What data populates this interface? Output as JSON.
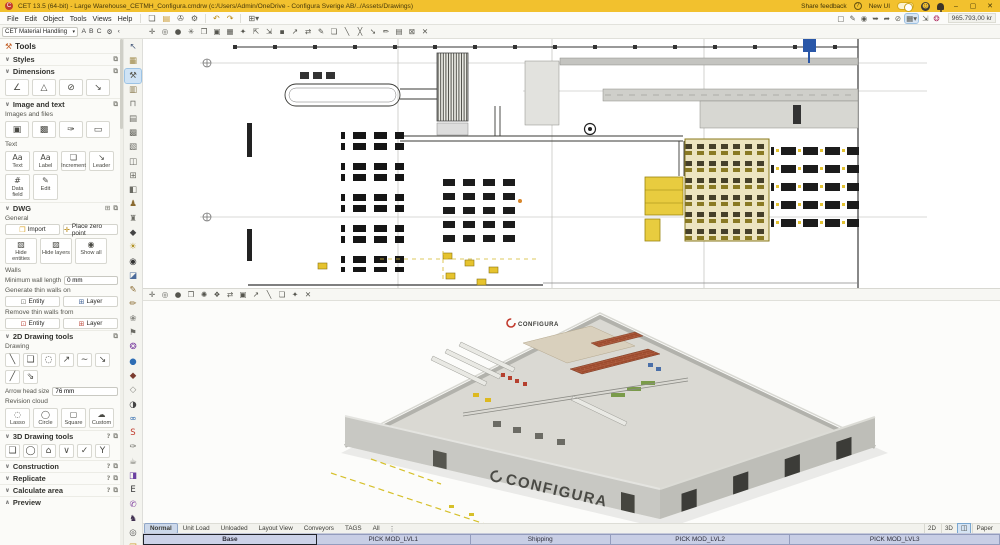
{
  "title_bar": {
    "app_title": "CET 13.5 (64-bit) - Large Warehouse_CETMH_Configura.cmdrw (c:/Users/Admin/OneDrive - Configura Sverige AB/../Assets/Drawings)",
    "share_feedback": "Share feedback",
    "new_ui": "New UI",
    "window_buttons": {
      "minimize": "–",
      "maximize": "▢",
      "close": "✕"
    }
  },
  "menubar": {
    "menus": [
      "File",
      "Edit",
      "Object",
      "Tools",
      "Views",
      "Help"
    ],
    "file_icons": [
      {
        "name": "new-drawing-icon",
        "glyph": "❏"
      },
      {
        "name": "open-folder-icon",
        "glyph": "▤",
        "color": "#c9972a"
      },
      {
        "name": "save-icon",
        "glyph": "✇"
      },
      {
        "name": "settings-gear-icon",
        "glyph": "⚙"
      }
    ],
    "history_icons": [
      {
        "name": "undo-icon",
        "glyph": "↶",
        "color": "#b8860b"
      },
      {
        "name": "redo-icon",
        "glyph": "↷",
        "color": "#b8860b"
      }
    ],
    "insert_icon": {
      "name": "insert-table-icon",
      "glyph": "⊞▾"
    },
    "right_icons": [
      {
        "name": "frame-icon",
        "glyph": "▢"
      },
      {
        "name": "draw-icon",
        "glyph": "✎"
      },
      {
        "name": "snap-point-icon",
        "glyph": "◉"
      },
      {
        "name": "snap-line-icon",
        "glyph": "➥"
      },
      {
        "name": "snap-angle-icon",
        "glyph": "➦"
      },
      {
        "name": "no-snap-icon",
        "glyph": "⊘"
      },
      {
        "name": "grid-settings-icon",
        "glyph": "▦▾",
        "selected": true
      },
      {
        "name": "measure-icon",
        "glyph": "⇲"
      },
      {
        "name": "record-icon",
        "glyph": "❂",
        "color": "#b03565"
      }
    ],
    "coordinates": "965.793,00 kr"
  },
  "ribbon": {
    "extension": "CET Material Handling",
    "letters": [
      "A",
      "B",
      "C"
    ],
    "gear": "⚙",
    "collapse": "‹"
  },
  "icon_strip": [
    {
      "name": "select-tool-icon",
      "glyph": "↖",
      "color": "#4a5d7e"
    },
    {
      "name": "pallets-icon",
      "glyph": "▦",
      "color": "#a08a4a"
    },
    {
      "name": "material-handling-tools-icon",
      "glyph": "⚒",
      "color": "#55534a",
      "selected": true
    },
    {
      "name": "unit-loads-icon",
      "glyph": "▥",
      "color": "#8a7a50"
    },
    {
      "name": "dock-equipment-icon",
      "glyph": "⊓",
      "color": "#6b6b64"
    },
    {
      "name": "pallet-rack-icon",
      "glyph": "▤",
      "color": "#6b6b64"
    },
    {
      "name": "shelving-icon",
      "glyph": "▩",
      "color": "#6b6b64"
    },
    {
      "name": "mezzanine-icon",
      "glyph": "▧",
      "color": "#6b6b64"
    },
    {
      "name": "conveyor-icon",
      "glyph": "◫",
      "color": "#6b6b64"
    },
    {
      "name": "workstation-icon",
      "glyph": "⊞",
      "color": "#6b6b64"
    },
    {
      "name": "machinery-icon",
      "glyph": "◧",
      "color": "#6b6b64"
    },
    {
      "name": "operator-icon",
      "glyph": "♟",
      "color": "#8a6a30"
    },
    {
      "name": "crane-icon",
      "glyph": "♜",
      "color": "#6b6b64"
    },
    {
      "name": "forklift-icon",
      "glyph": "◆",
      "color": "#444444"
    },
    {
      "name": "lighting-icon",
      "glyph": "☀",
      "color": "#b09020"
    },
    {
      "name": "vehicle-icon",
      "glyph": "◉",
      "color": "#333333"
    },
    {
      "name": "monitor-icon",
      "glyph": "◪",
      "color": "#4a6a9a"
    },
    {
      "name": "pencil-icon",
      "glyph": "✎",
      "color": "#8a6a30"
    },
    {
      "name": "sketch-icon",
      "glyph": "✏",
      "color": "#8a6a30"
    },
    {
      "name": "render-icon",
      "glyph": "❀",
      "color": "#8a8a84"
    },
    {
      "name": "flag-icon",
      "glyph": "⚑",
      "color": "#6b6b64"
    },
    {
      "name": "pinwheel-icon",
      "glyph": "❂",
      "color": "#7b3fa0"
    },
    {
      "name": "globe-icon",
      "glyph": "●",
      "color": "#2e6db4"
    },
    {
      "name": "cad-icon",
      "glyph": "◆",
      "color": "#7a3b2e"
    },
    {
      "name": "export-icon",
      "glyph": "◇",
      "color": "#8a8a84"
    },
    {
      "name": "gauge-icon",
      "glyph": "◑",
      "color": "#444444"
    },
    {
      "name": "sync-icon",
      "glyph": "∞",
      "color": "#1f5fa8"
    },
    {
      "name": "sketchup-icon",
      "glyph": "S",
      "color": "#c0392b"
    },
    {
      "name": "annotation-icon",
      "glyph": "✑",
      "color": "#6b6b64"
    },
    {
      "name": "bucket-icon",
      "glyph": "☕",
      "color": "#6b6b64"
    },
    {
      "name": "media-panel-icon",
      "glyph": "◨",
      "color": "#6a3fa0"
    },
    {
      "name": "e-learning-icon",
      "glyph": "E",
      "color": "#333333"
    },
    {
      "name": "support-icon",
      "glyph": "✆",
      "color": "#8040a0"
    },
    {
      "name": "figure-icon",
      "glyph": "♞",
      "color": "#403050"
    },
    {
      "name": "search-icon",
      "glyph": "◎",
      "color": "#555555"
    },
    {
      "name": "folder-icon",
      "glyph": "❒",
      "color": "#d0a030"
    }
  ],
  "sidebar": {
    "title": "Tools",
    "sections": {
      "styles": "Styles",
      "dimensions": "Dimensions",
      "image_text": "Image and text",
      "dwg": "DWG",
      "drawing2d": "2D Drawing tools",
      "drawing3d": "3D Drawing tools",
      "construction": "Construction",
      "replicate": "Replicate",
      "calculate": "Calculate area",
      "preview": "Preview"
    },
    "dimension_tools": [
      {
        "name": "angular-dimension-icon",
        "glyph": "∠"
      },
      {
        "name": "area-dimension-icon",
        "glyph": "△"
      },
      {
        "name": "diameter-dimension-icon",
        "glyph": "⊘"
      },
      {
        "name": "linear-dimension-icon",
        "glyph": "↘"
      }
    ],
    "images_files_label": "Images and files",
    "image_tools": [
      {
        "name": "insert-image-icon",
        "glyph": "▣"
      },
      {
        "name": "image-frame-icon",
        "glyph": "▩"
      },
      {
        "name": "attach-file-icon",
        "glyph": "✑"
      },
      {
        "name": "viewport-image-icon",
        "glyph": "▭"
      }
    ],
    "text_label": "Text",
    "text_tools": [
      {
        "label": "Text",
        "glyph": "Aa",
        "name": "text-tool"
      },
      {
        "label": "Label",
        "glyph": "Aa",
        "name": "label-tool"
      },
      {
        "label": "Increment",
        "glyph": "❏",
        "name": "increment-tool"
      },
      {
        "label": "Leader",
        "glyph": "↘",
        "name": "leader-tool"
      },
      {
        "label": "Data field",
        "glyph": "#",
        "name": "data-field-tool"
      },
      {
        "label": "Edit",
        "glyph": "✎",
        "name": "edit-text-tool"
      }
    ],
    "dwg": {
      "general_label": "General",
      "import_label": "Import",
      "place_zero_label": "Place zero point",
      "view_buttons": [
        {
          "label": "Hide entities",
          "glyph": "▧",
          "name": "hide-entities-button"
        },
        {
          "label": "Hide layers",
          "glyph": "▨",
          "name": "hide-layers-button"
        },
        {
          "label": "Show all",
          "glyph": "◉",
          "name": "show-all-button"
        }
      ],
      "walls_label": "Walls",
      "min_wall_label": "Minimum wall length",
      "min_wall_value": "0 mm",
      "generate_label": "Generate thin walls on",
      "remove_label": "Remove thin walls from",
      "entity_label": "Entity",
      "layer_label": "Layer"
    },
    "drawing2d": {
      "drawing_label": "Drawing",
      "tools": [
        {
          "name": "line-tool-icon",
          "glyph": "╲"
        },
        {
          "name": "rectangle-tool-icon",
          "glyph": "❑"
        },
        {
          "name": "circle-tool-icon",
          "glyph": "◌"
        },
        {
          "name": "arrow-tool-icon",
          "glyph": "↗"
        },
        {
          "name": "curve-tool-icon",
          "glyph": "∼"
        },
        {
          "name": "double-arrow-tool-icon",
          "glyph": "↘"
        },
        {
          "name": "polyline-tool-icon",
          "glyph": "╱"
        },
        {
          "name": "leader-arrow-tool-icon",
          "glyph": "⇘"
        }
      ],
      "arrow_label": "Arrow head size",
      "arrow_value": "76 mm",
      "revision_label": "Revision cloud",
      "revision_tools": [
        {
          "label": "Lasso",
          "glyph": "◌",
          "name": "revision-lasso-tool"
        },
        {
          "label": "Circle",
          "glyph": "◯",
          "name": "revision-circle-tool"
        },
        {
          "label": "Square",
          "glyph": "▢",
          "name": "revision-square-tool"
        },
        {
          "label": "Custom",
          "glyph": "☁",
          "color": "#a06a9a",
          "name": "revision-custom-tool"
        }
      ]
    },
    "drawing3d_tools": [
      {
        "name": "box-3d-icon",
        "glyph": "❑"
      },
      {
        "name": "cylinder-3d-icon",
        "glyph": "◯"
      },
      {
        "name": "polygon-3d-icon",
        "glyph": "⌂"
      },
      {
        "name": "valley-3d-icon",
        "glyph": "∨"
      },
      {
        "name": "check-3d-icon",
        "glyph": "✓"
      },
      {
        "name": "wye-3d-icon",
        "glyph": "Y"
      }
    ]
  },
  "viewport2d": {
    "toolbar": [
      {
        "name": "pan-icon",
        "glyph": "✛"
      },
      {
        "name": "zoom-icon",
        "glyph": "◎"
      },
      {
        "name": "zoom-selection-icon",
        "glyph": "●"
      },
      {
        "name": "zoom-extents-icon",
        "glyph": "✳"
      },
      {
        "name": "previous-view-icon",
        "glyph": "❐"
      },
      {
        "name": "save-view-icon",
        "glyph": "▣"
      },
      {
        "name": "grid-icon",
        "glyph": "▦"
      },
      {
        "name": "snap-icon",
        "glyph": "✦"
      },
      {
        "name": "send-back-icon",
        "glyph": "⇱"
      },
      {
        "name": "bring-front-icon",
        "glyph": "⇲"
      },
      {
        "name": "fill-icon",
        "glyph": "▪"
      },
      {
        "name": "move-icon",
        "glyph": "↗"
      },
      {
        "name": "swap-icon",
        "glyph": "⇄"
      },
      {
        "name": "edit-icon",
        "glyph": "✎"
      },
      {
        "name": "copy-icon",
        "glyph": "❏"
      },
      {
        "name": "line-icon",
        "glyph": "╲"
      },
      {
        "name": "erase-icon",
        "glyph": "╳"
      },
      {
        "name": "arrow-icon",
        "glyph": "➘"
      },
      {
        "name": "annotate-icon",
        "glyph": "✏"
      },
      {
        "name": "layers-icon",
        "glyph": "▤"
      },
      {
        "name": "region-icon",
        "glyph": "⊠"
      },
      {
        "name": "close-viewport-icon",
        "glyph": "✕"
      }
    ]
  },
  "viewport3d": {
    "toolbar": [
      {
        "name": "pan-3d-icon",
        "glyph": "✛"
      },
      {
        "name": "zoom-3d-icon",
        "glyph": "◎"
      },
      {
        "name": "zoom-selection-3d-icon",
        "glyph": "●"
      },
      {
        "name": "fit-view-icon",
        "glyph": "❒"
      },
      {
        "name": "orbit-icon",
        "glyph": "✺"
      },
      {
        "name": "walkthrough-icon",
        "glyph": "❖"
      },
      {
        "name": "swap-3d-icon",
        "glyph": "⇄"
      },
      {
        "name": "render-mode-icon",
        "glyph": "▣"
      },
      {
        "name": "move-3d-icon",
        "glyph": "↗"
      },
      {
        "name": "section-icon",
        "glyph": "╲"
      },
      {
        "name": "copy-3d-icon",
        "glyph": "❏"
      },
      {
        "name": "sun-icon",
        "glyph": "✦"
      },
      {
        "name": "close-3d-viewport-icon",
        "glyph": "✕"
      }
    ],
    "wall_text": "CONFIGURA",
    "logo_text": "CONFIGURA"
  },
  "tabs": {
    "items": [
      {
        "label": "Normal",
        "selected": true
      },
      {
        "label": "Unit Load"
      },
      {
        "label": "Unloaded"
      },
      {
        "label": "Layout View"
      },
      {
        "label": "Conveyors"
      },
      {
        "label": "TAGS"
      },
      {
        "label": "All"
      }
    ],
    "more_icon": "⋮",
    "view_2d": "2D",
    "view_3d": "3D",
    "split_icon": "◫",
    "paper": "Paper"
  },
  "levels": [
    {
      "label": "Base",
      "selected": true
    },
    {
      "label": "PICK MOD_LVL1"
    },
    {
      "label": "Shipping"
    },
    {
      "label": "PICK MOD_LVL2"
    },
    {
      "label": "PICK MOD_LVL3"
    }
  ]
}
